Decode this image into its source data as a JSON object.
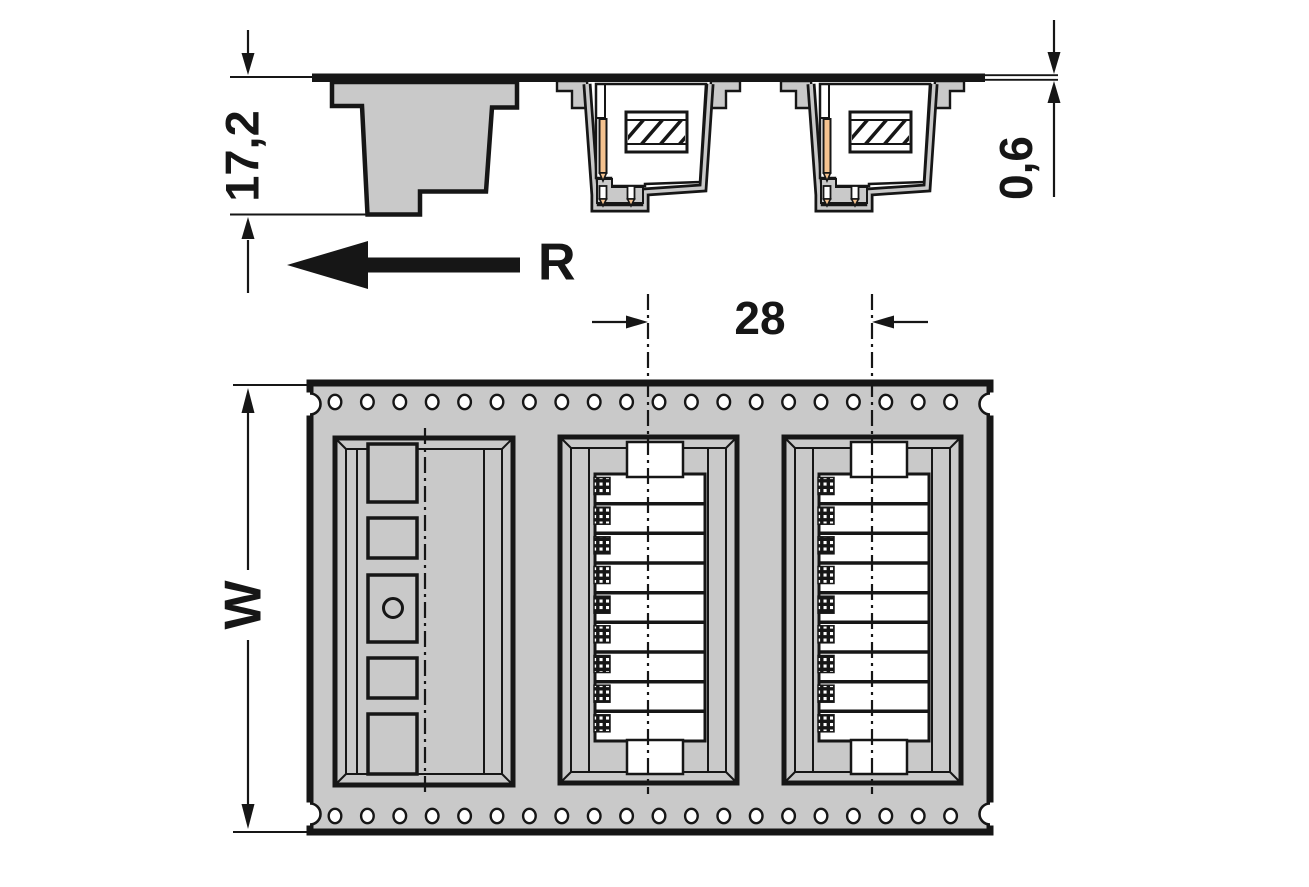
{
  "drawing": {
    "type": "technical-dimension-drawing",
    "subject": "connectors in tape-and-reel carrier packaging (section view and top view)",
    "colors": {
      "tape_gray": "#c9c9c9",
      "line_black": "#161616",
      "pin_orange": "#f4c28f",
      "pocket_white": "#ffffff"
    },
    "section_view": {
      "dim_pocket_depth": "17,2",
      "dim_tape_thickness": "0,6",
      "unreeling_direction_label": "R",
      "connector_sections": 2
    },
    "top_view": {
      "dim_pocket_pitch": "28",
      "dim_tape_width": "W",
      "sprocket_holes_per_row": 20,
      "sprocket_hole_rows": 2,
      "pockets_total": 3,
      "empty_pockets": 1,
      "loaded_pockets": 2,
      "compartments_per_connector": 9
    }
  }
}
